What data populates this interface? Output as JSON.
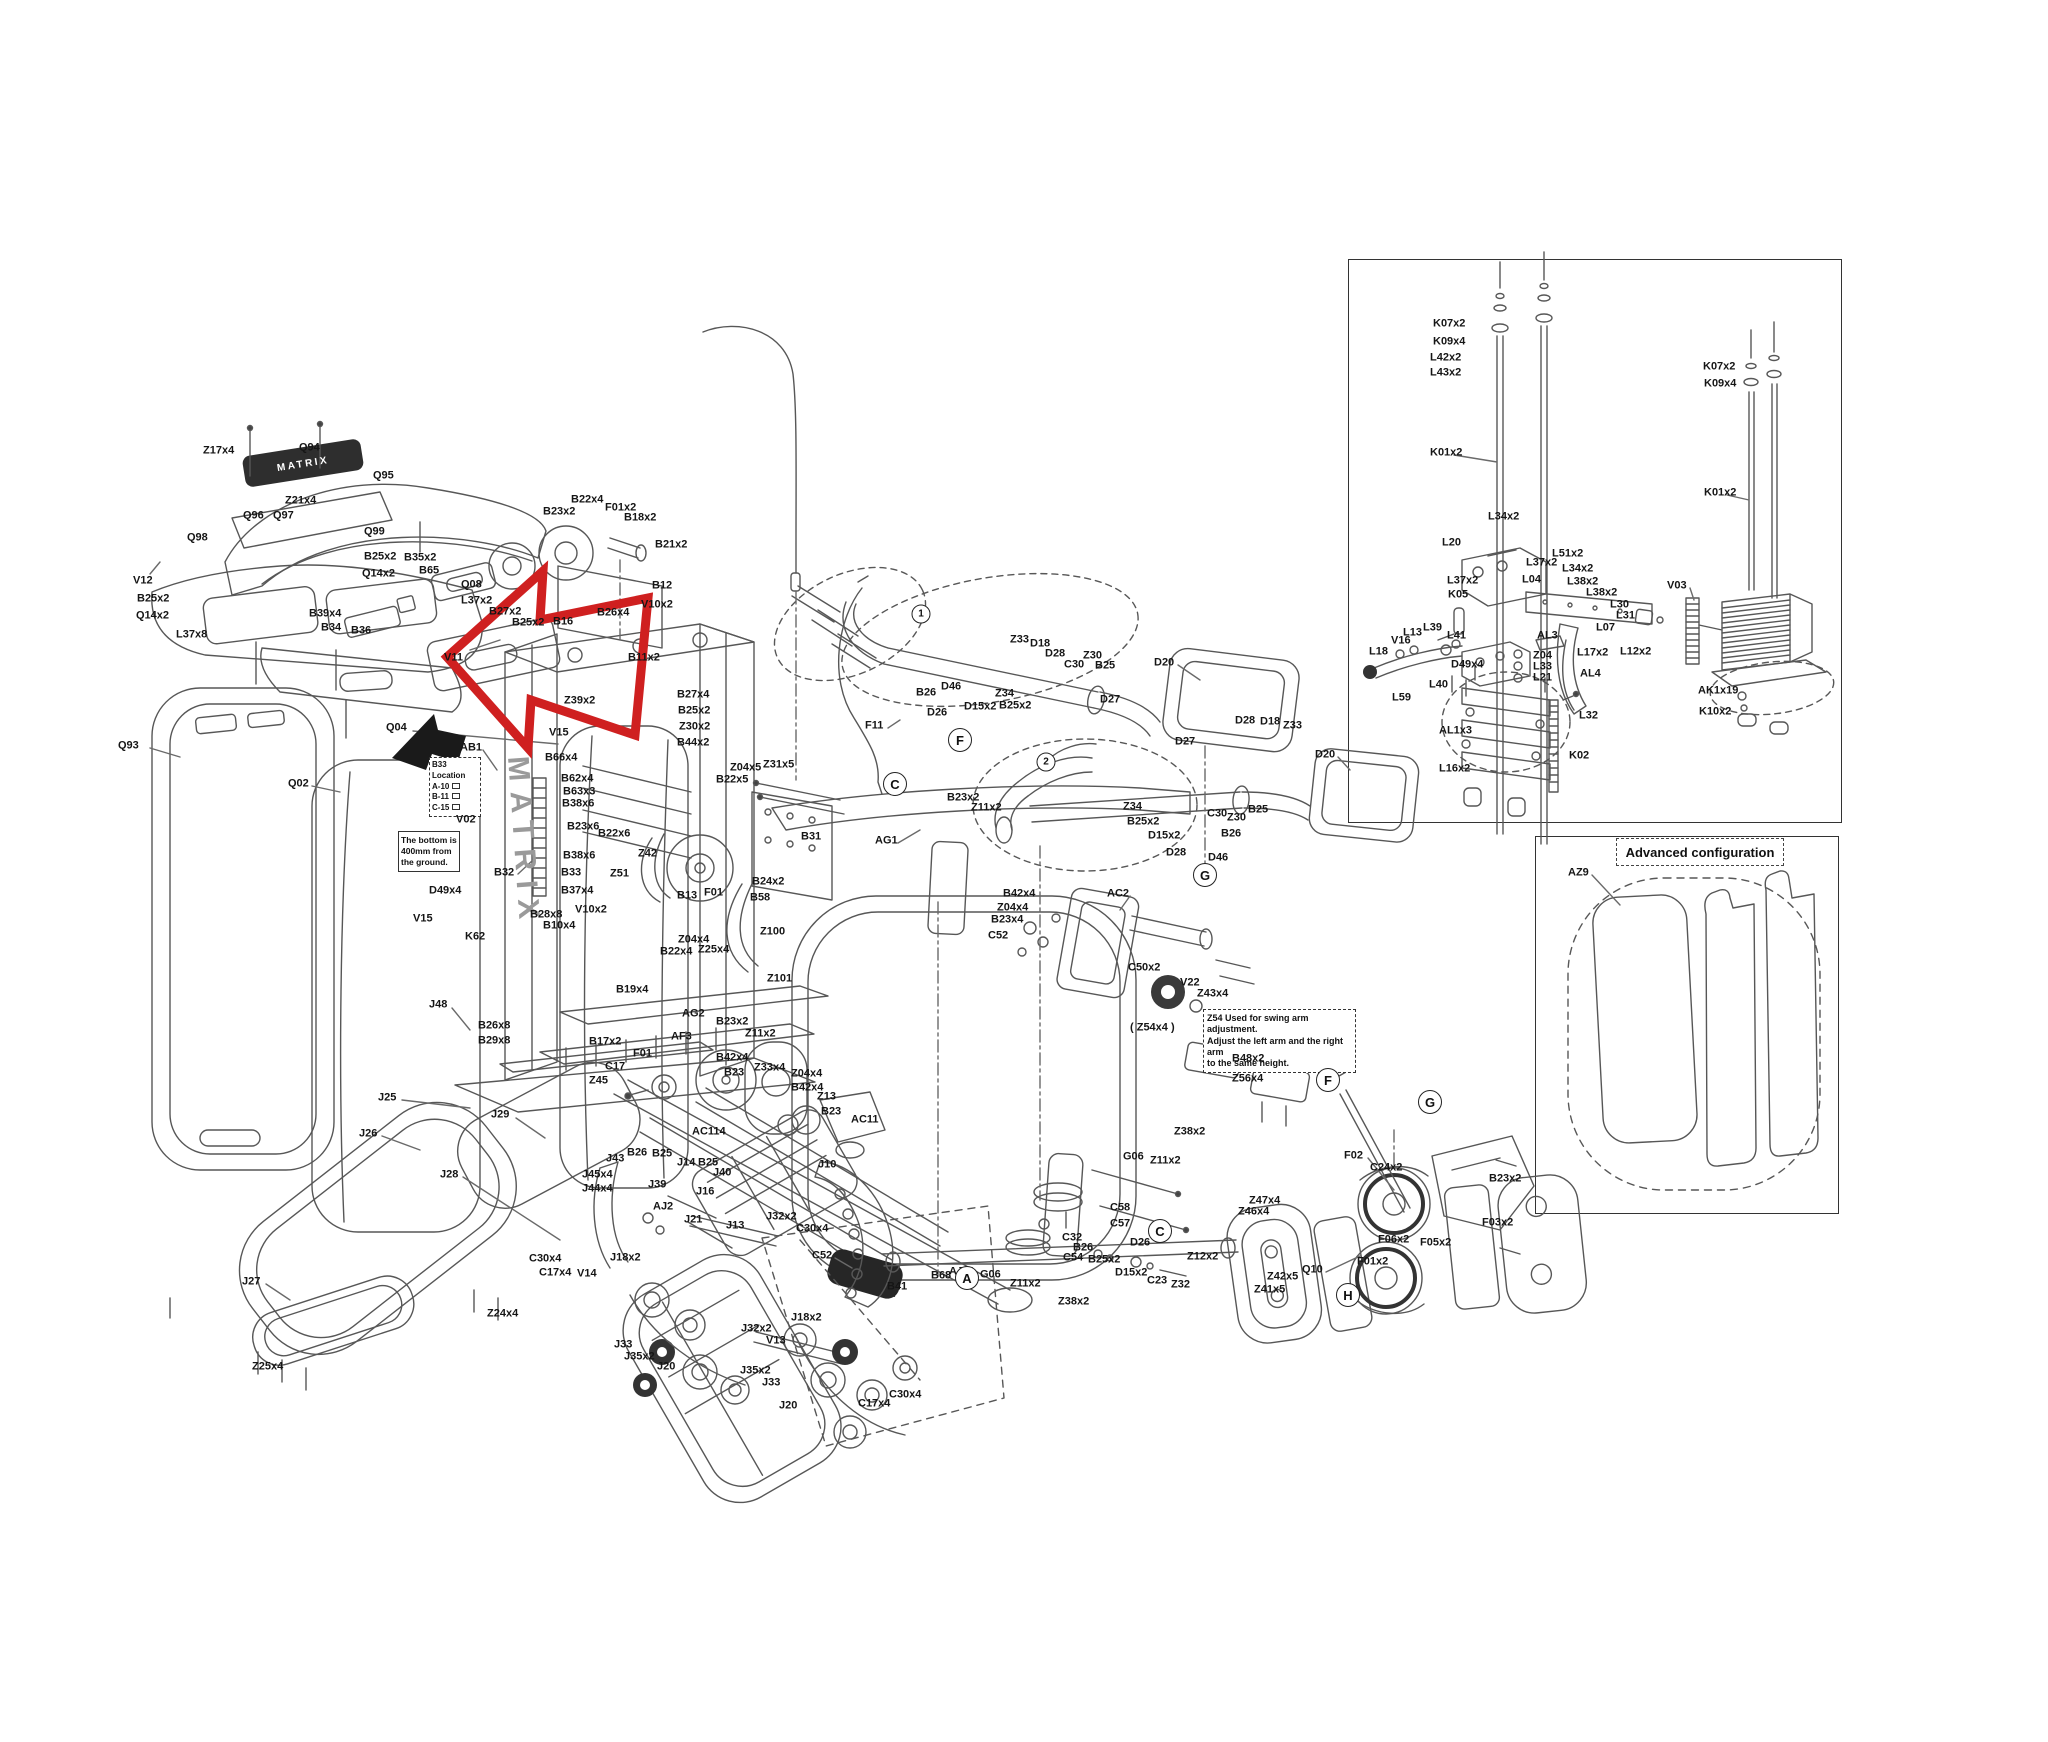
{
  "brand": {
    "logo": "MATRIX",
    "frame_text": "MATRIX"
  },
  "advanced": {
    "title": "Advanced configuration"
  },
  "notes": {
    "b33": {
      "l1": "B33",
      "l2": "Location",
      "l3": "A-10",
      "l4": "B-11",
      "l5": "C-15"
    },
    "ground": {
      "l1": "The bottom is",
      "l2": "400mm from",
      "l3": "the ground."
    },
    "z54": {
      "l1": "Z54 Used for swing arm adjustment.",
      "l2": "Adjust the left arm and the right arm",
      "l3": "to the same height."
    }
  },
  "circles": [
    {
      "t": "1",
      "x": 921,
      "y": 614,
      "sm": true
    },
    {
      "t": "2",
      "x": 1046,
      "y": 762,
      "sm": true
    },
    {
      "t": "C",
      "x": 895,
      "y": 784
    },
    {
      "t": "F",
      "x": 960,
      "y": 740
    },
    {
      "t": "G",
      "x": 1205,
      "y": 875
    },
    {
      "t": "A",
      "x": 967,
      "y": 1278
    },
    {
      "t": "C",
      "x": 1160,
      "y": 1231
    },
    {
      "t": "F",
      "x": 1328,
      "y": 1080
    },
    {
      "t": "G",
      "x": 1430,
      "y": 1102
    },
    {
      "t": "H",
      "x": 1348,
      "y": 1295
    }
  ],
  "labels": [
    {
      "t": "Z17x4",
      "x": 203,
      "y": 451
    },
    {
      "t": "Q94",
      "x": 299,
      "y": 448
    },
    {
      "t": "Q95",
      "x": 373,
      "y": 476
    },
    {
      "t": "Z21x4",
      "x": 285,
      "y": 501
    },
    {
      "t": "Q96",
      "x": 243,
      "y": 516
    },
    {
      "t": "Q97",
      "x": 273,
      "y": 516
    },
    {
      "t": "Q98",
      "x": 187,
      "y": 538
    },
    {
      "t": "Q99",
      "x": 364,
      "y": 532
    },
    {
      "t": "B25x2",
      "x": 364,
      "y": 557
    },
    {
      "t": "Q14x2",
      "x": 362,
      "y": 574
    },
    {
      "t": "B35x2",
      "x": 404,
      "y": 558
    },
    {
      "t": "B65",
      "x": 419,
      "y": 571
    },
    {
      "t": "V12",
      "x": 133,
      "y": 581
    },
    {
      "t": "B25x2",
      "x": 137,
      "y": 599
    },
    {
      "t": "Q14x2",
      "x": 136,
      "y": 616
    },
    {
      "t": "L37x8",
      "x": 176,
      "y": 635
    },
    {
      "t": "Q08",
      "x": 461,
      "y": 585
    },
    {
      "t": "L37x2",
      "x": 461,
      "y": 601
    },
    {
      "t": "B39x4",
      "x": 309,
      "y": 614
    },
    {
      "t": "B34",
      "x": 321,
      "y": 628
    },
    {
      "t": "B36",
      "x": 351,
      "y": 631
    },
    {
      "t": "V11",
      "x": 444,
      "y": 658
    },
    {
      "t": "Q93",
      "x": 118,
      "y": 746
    },
    {
      "t": "Q02",
      "x": 288,
      "y": 784
    },
    {
      "t": "Q04",
      "x": 386,
      "y": 728
    },
    {
      "t": "AB1",
      "x": 460,
      "y": 748
    },
    {
      "t": "V02",
      "x": 456,
      "y": 820
    },
    {
      "t": "D49x4",
      "x": 429,
      "y": 891
    },
    {
      "t": "V15",
      "x": 413,
      "y": 919
    },
    {
      "t": "K62",
      "x": 465,
      "y": 937
    },
    {
      "t": "J48",
      "x": 429,
      "y": 1005
    },
    {
      "t": "B23x2",
      "x": 543,
      "y": 512
    },
    {
      "t": "B22x4",
      "x": 571,
      "y": 500
    },
    {
      "t": "F01x2",
      "x": 605,
      "y": 508
    },
    {
      "t": "B18x2",
      "x": 624,
      "y": 518
    },
    {
      "t": "B21x2",
      "x": 655,
      "y": 545
    },
    {
      "t": "B12",
      "x": 652,
      "y": 586
    },
    {
      "t": "V10x2",
      "x": 641,
      "y": 605
    },
    {
      "t": "B26x4",
      "x": 597,
      "y": 613
    },
    {
      "t": "B16",
      "x": 553,
      "y": 622
    },
    {
      "t": "B27x2",
      "x": 489,
      "y": 612
    },
    {
      "t": "B25x2",
      "x": 512,
      "y": 623
    },
    {
      "t": "B11x2",
      "x": 628,
      "y": 658
    },
    {
      "t": "B27x4",
      "x": 677,
      "y": 695
    },
    {
      "t": "B25x2",
      "x": 678,
      "y": 711
    },
    {
      "t": "Z30x2",
      "x": 679,
      "y": 727
    },
    {
      "t": "B44x2",
      "x": 677,
      "y": 743
    },
    {
      "t": "Z39x2",
      "x": 564,
      "y": 701
    },
    {
      "t": "V15",
      "x": 549,
      "y": 733
    },
    {
      "t": "B66x4",
      "x": 545,
      "y": 758
    },
    {
      "t": "B62x4",
      "x": 561,
      "y": 779
    },
    {
      "t": "B63x3",
      "x": 563,
      "y": 792
    },
    {
      "t": "B38x6",
      "x": 562,
      "y": 804
    },
    {
      "t": "B23x6",
      "x": 567,
      "y": 827
    },
    {
      "t": "B22x6",
      "x": 598,
      "y": 834
    },
    {
      "t": "B38x6",
      "x": 563,
      "y": 856
    },
    {
      "t": "B33",
      "x": 561,
      "y": 873
    },
    {
      "t": "B32",
      "x": 494,
      "y": 873
    },
    {
      "t": "B37x4",
      "x": 561,
      "y": 891
    },
    {
      "t": "V10x2",
      "x": 575,
      "y": 910
    },
    {
      "t": "B28x8",
      "x": 530,
      "y": 915
    },
    {
      "t": "B10x4",
      "x": 543,
      "y": 926
    },
    {
      "t": "Z42",
      "x": 638,
      "y": 854
    },
    {
      "t": "Z51",
      "x": 610,
      "y": 874
    },
    {
      "t": "B13",
      "x": 677,
      "y": 896
    },
    {
      "t": "F01",
      "x": 704,
      "y": 893
    },
    {
      "t": "B24x2",
      "x": 752,
      "y": 882
    },
    {
      "t": "B58",
      "x": 750,
      "y": 898
    },
    {
      "t": "Z100",
      "x": 760,
      "y": 932
    },
    {
      "t": "Z04x4",
      "x": 678,
      "y": 940
    },
    {
      "t": "B22x4",
      "x": 660,
      "y": 952
    },
    {
      "t": "Z25x4",
      "x": 698,
      "y": 950
    },
    {
      "t": "Z101",
      "x": 767,
      "y": 979
    },
    {
      "t": "B19x4",
      "x": 616,
      "y": 990
    },
    {
      "t": "AG2",
      "x": 682,
      "y": 1014
    },
    {
      "t": "B23x2",
      "x": 716,
      "y": 1022
    },
    {
      "t": "Z11x2",
      "x": 745,
      "y": 1034
    },
    {
      "t": "B26x8",
      "x": 478,
      "y": 1026
    },
    {
      "t": "B29x8",
      "x": 478,
      "y": 1041
    },
    {
      "t": "B17x2",
      "x": 589,
      "y": 1042
    },
    {
      "t": "Z04x5",
      "x": 730,
      "y": 768
    },
    {
      "t": "Z31x5",
      "x": 763,
      "y": 765
    },
    {
      "t": "B22x5",
      "x": 716,
      "y": 780
    },
    {
      "t": "B31",
      "x": 801,
      "y": 837
    },
    {
      "t": "AG1",
      "x": 875,
      "y": 841
    },
    {
      "t": "AF3",
      "x": 671,
      "y": 1037
    },
    {
      "t": "F01",
      "x": 633,
      "y": 1054
    },
    {
      "t": "C17",
      "x": 605,
      "y": 1067
    },
    {
      "t": "Z45",
      "x": 589,
      "y": 1081
    },
    {
      "t": "B42x4",
      "x": 716,
      "y": 1058
    },
    {
      "t": "B23",
      "x": 724,
      "y": 1073
    },
    {
      "t": "Z33x4",
      "x": 754,
      "y": 1068
    },
    {
      "t": "Z04x4",
      "x": 791,
      "y": 1074
    },
    {
      "t": "B42x4",
      "x": 791,
      "y": 1088
    },
    {
      "t": "Z13",
      "x": 817,
      "y": 1097
    },
    {
      "t": "B23",
      "x": 821,
      "y": 1112
    },
    {
      "t": "AC11",
      "x": 851,
      "y": 1120
    },
    {
      "t": "AC114",
      "x": 692,
      "y": 1132
    },
    {
      "t": "J10",
      "x": 818,
      "y": 1165
    },
    {
      "t": "J32x2",
      "x": 766,
      "y": 1217
    },
    {
      "t": "C30x4",
      "x": 796,
      "y": 1229
    },
    {
      "t": "C52",
      "x": 812,
      "y": 1256
    },
    {
      "t": "B41",
      "x": 887,
      "y": 1287
    },
    {
      "t": "B68",
      "x": 931,
      "y": 1276
    },
    {
      "t": "G06",
      "x": 980,
      "y": 1275
    },
    {
      "t": "Z11x2",
      "x": 1010,
      "y": 1284
    },
    {
      "t": "Z38x2",
      "x": 1058,
      "y": 1302
    },
    {
      "t": "C58",
      "x": 1110,
      "y": 1208
    },
    {
      "t": "C57",
      "x": 1110,
      "y": 1224
    },
    {
      "t": "C32",
      "x": 1062,
      "y": 1238
    },
    {
      "t": "B26",
      "x": 1073,
      "y": 1248
    },
    {
      "t": "C54",
      "x": 1063,
      "y": 1258
    },
    {
      "t": "B25x2",
      "x": 1088,
      "y": 1260
    },
    {
      "t": "D26",
      "x": 1130,
      "y": 1243
    },
    {
      "t": "D15x2",
      "x": 1115,
      "y": 1273
    },
    {
      "t": "C23",
      "x": 1147,
      "y": 1281
    },
    {
      "t": "Z32",
      "x": 1171,
      "y": 1285
    },
    {
      "t": "AJ11",
      "x": 949,
      "y": 1272
    },
    {
      "t": "Z33",
      "x": 1010,
      "y": 640
    },
    {
      "t": "D18",
      "x": 1030,
      "y": 644
    },
    {
      "t": "D28",
      "x": 1045,
      "y": 654
    },
    {
      "t": "C30",
      "x": 1064,
      "y": 665
    },
    {
      "t": "Z30",
      "x": 1083,
      "y": 656
    },
    {
      "t": "B25",
      "x": 1095,
      "y": 666
    },
    {
      "t": "D20",
      "x": 1154,
      "y": 663
    },
    {
      "t": "D27",
      "x": 1100,
      "y": 700
    },
    {
      "t": "B26",
      "x": 916,
      "y": 693
    },
    {
      "t": "D46",
      "x": 941,
      "y": 687
    },
    {
      "t": "Z34",
      "x": 995,
      "y": 694
    },
    {
      "t": "D15x2",
      "x": 964,
      "y": 707
    },
    {
      "t": "B25x2",
      "x": 999,
      "y": 706
    },
    {
      "t": "D26",
      "x": 927,
      "y": 713
    },
    {
      "t": "F11",
      "x": 865,
      "y": 726
    },
    {
      "t": "B23x2",
      "x": 947,
      "y": 798
    },
    {
      "t": "Z11x2",
      "x": 971,
      "y": 808
    },
    {
      "t": "D27",
      "x": 1175,
      "y": 742
    },
    {
      "t": "D28",
      "x": 1235,
      "y": 721
    },
    {
      "t": "D18",
      "x": 1260,
      "y": 722
    },
    {
      "t": "Z33",
      "x": 1283,
      "y": 726
    },
    {
      "t": "D20",
      "x": 1315,
      "y": 755
    },
    {
      "t": "Z34",
      "x": 1123,
      "y": 807
    },
    {
      "t": "B25x2",
      "x": 1127,
      "y": 822
    },
    {
      "t": "C30",
      "x": 1207,
      "y": 814
    },
    {
      "t": "Z30",
      "x": 1227,
      "y": 818
    },
    {
      "t": "B25",
      "x": 1248,
      "y": 810
    },
    {
      "t": "B26",
      "x": 1221,
      "y": 834
    },
    {
      "t": "D15x2",
      "x": 1148,
      "y": 836
    },
    {
      "t": "D28",
      "x": 1166,
      "y": 853
    },
    {
      "t": "D46",
      "x": 1208,
      "y": 858
    },
    {
      "t": "B42x4",
      "x": 1003,
      "y": 894
    },
    {
      "t": "Z04x4",
      "x": 997,
      "y": 908
    },
    {
      "t": "B23x4",
      "x": 991,
      "y": 920
    },
    {
      "t": "C52",
      "x": 988,
      "y": 936
    },
    {
      "t": "AC2",
      "x": 1107,
      "y": 894
    },
    {
      "t": "C50x2",
      "x": 1128,
      "y": 968
    },
    {
      "t": "V22",
      "x": 1180,
      "y": 983
    },
    {
      "t": "Z43x4",
      "x": 1197,
      "y": 994
    },
    {
      "t": "( Z54x4 )",
      "x": 1130,
      "y": 1028
    },
    {
      "t": "B48x2",
      "x": 1232,
      "y": 1059
    },
    {
      "t": "Z56x4",
      "x": 1232,
      "y": 1079
    },
    {
      "t": "Z38x2",
      "x": 1174,
      "y": 1132
    },
    {
      "t": "G06",
      "x": 1123,
      "y": 1157
    },
    {
      "t": "Z11x2",
      "x": 1150,
      "y": 1161
    },
    {
      "t": "F02",
      "x": 1344,
      "y": 1156
    },
    {
      "t": "C24x2",
      "x": 1370,
      "y": 1168
    },
    {
      "t": "Z47x4",
      "x": 1249,
      "y": 1201
    },
    {
      "t": "Z46x4",
      "x": 1238,
      "y": 1212
    },
    {
      "t": "Z12x2",
      "x": 1187,
      "y": 1257
    },
    {
      "t": "Z42x5",
      "x": 1267,
      "y": 1277
    },
    {
      "t": "Z41x5",
      "x": 1254,
      "y": 1290
    },
    {
      "t": "Q10",
      "x": 1302,
      "y": 1270
    },
    {
      "t": "F01x2",
      "x": 1357,
      "y": 1262
    },
    {
      "t": "F06x2",
      "x": 1378,
      "y": 1240
    },
    {
      "t": "F05x2",
      "x": 1420,
      "y": 1243
    },
    {
      "t": "F03x2",
      "x": 1482,
      "y": 1223
    },
    {
      "t": "B23x2",
      "x": 1489,
      "y": 1179
    },
    {
      "t": "J25",
      "x": 378,
      "y": 1098
    },
    {
      "t": "J26",
      "x": 359,
      "y": 1134
    },
    {
      "t": "J29",
      "x": 491,
      "y": 1115
    },
    {
      "t": "J28",
      "x": 440,
      "y": 1175
    },
    {
      "t": "J27",
      "x": 242,
      "y": 1282
    },
    {
      "t": "Z25x4",
      "x": 252,
      "y": 1367
    },
    {
      "t": "Z24x4",
      "x": 487,
      "y": 1314
    },
    {
      "t": "J43",
      "x": 606,
      "y": 1159
    },
    {
      "t": "B26",
      "x": 627,
      "y": 1153
    },
    {
      "t": "B25",
      "x": 652,
      "y": 1154
    },
    {
      "t": "J45x4",
      "x": 582,
      "y": 1175
    },
    {
      "t": "J44x4",
      "x": 582,
      "y": 1189
    },
    {
      "t": "J14",
      "x": 677,
      "y": 1163
    },
    {
      "t": "B25",
      "x": 698,
      "y": 1163
    },
    {
      "t": "J40",
      "x": 713,
      "y": 1173
    },
    {
      "t": "J39",
      "x": 648,
      "y": 1185
    },
    {
      "t": "J16",
      "x": 696,
      "y": 1192
    },
    {
      "t": "AJ2",
      "x": 653,
      "y": 1207
    },
    {
      "t": "J21",
      "x": 684,
      "y": 1220
    },
    {
      "t": "J13",
      "x": 726,
      "y": 1226
    },
    {
      "t": "C30x4",
      "x": 529,
      "y": 1259
    },
    {
      "t": "C17x4",
      "x": 539,
      "y": 1273
    },
    {
      "t": "V14",
      "x": 577,
      "y": 1274
    },
    {
      "t": "J18x2",
      "x": 610,
      "y": 1258
    },
    {
      "t": "J33",
      "x": 614,
      "y": 1345
    },
    {
      "t": "J35x2",
      "x": 624,
      "y": 1357
    },
    {
      "t": "J20",
      "x": 657,
      "y": 1367
    },
    {
      "t": "J32x2",
      "x": 741,
      "y": 1329
    },
    {
      "t": "V13",
      "x": 766,
      "y": 1341
    },
    {
      "t": "J35x2",
      "x": 740,
      "y": 1371
    },
    {
      "t": "J33",
      "x": 762,
      "y": 1383
    },
    {
      "t": "J20",
      "x": 779,
      "y": 1406
    },
    {
      "t": "J18x2",
      "x": 791,
      "y": 1318
    },
    {
      "t": "C30x4",
      "x": 889,
      "y": 1395
    },
    {
      "t": "C17x4",
      "x": 858,
      "y": 1404
    },
    {
      "t": "K07x2",
      "x": 1433,
      "y": 324
    },
    {
      "t": "K09x4",
      "x": 1433,
      "y": 342
    },
    {
      "t": "L42x2",
      "x": 1430,
      "y": 358
    },
    {
      "t": "L43x2",
      "x": 1430,
      "y": 373
    },
    {
      "t": "K01x2",
      "x": 1430,
      "y": 453
    },
    {
      "t": "L34x2",
      "x": 1488,
      "y": 517
    },
    {
      "t": "L20",
      "x": 1442,
      "y": 543
    },
    {
      "t": "L37x2",
      "x": 1526,
      "y": 563
    },
    {
      "t": "L51x2",
      "x": 1552,
      "y": 554
    },
    {
      "t": "L34x2",
      "x": 1562,
      "y": 569
    },
    {
      "t": "L04",
      "x": 1522,
      "y": 580
    },
    {
      "t": "L38x2",
      "x": 1567,
      "y": 582
    },
    {
      "t": "L38x2",
      "x": 1586,
      "y": 593
    },
    {
      "t": "L37x2",
      "x": 1447,
      "y": 581
    },
    {
      "t": "K05",
      "x": 1448,
      "y": 595
    },
    {
      "t": "L30",
      "x": 1610,
      "y": 605
    },
    {
      "t": "L31",
      "x": 1616,
      "y": 616
    },
    {
      "t": "L07",
      "x": 1596,
      "y": 628
    },
    {
      "t": "L13",
      "x": 1403,
      "y": 633
    },
    {
      "t": "L39",
      "x": 1423,
      "y": 628
    },
    {
      "t": "V16",
      "x": 1391,
      "y": 641
    },
    {
      "t": "L18",
      "x": 1369,
      "y": 652
    },
    {
      "t": "L41",
      "x": 1447,
      "y": 636
    },
    {
      "t": "AL3",
      "x": 1537,
      "y": 636
    },
    {
      "t": "Z04",
      "x": 1533,
      "y": 656
    },
    {
      "t": "L33",
      "x": 1533,
      "y": 667
    },
    {
      "t": "L21",
      "x": 1533,
      "y": 678
    },
    {
      "t": "L17x2",
      "x": 1577,
      "y": 653
    },
    {
      "t": "L12x2",
      "x": 1620,
      "y": 652
    },
    {
      "t": "AL4",
      "x": 1580,
      "y": 674
    },
    {
      "t": "D49x4",
      "x": 1451,
      "y": 665
    },
    {
      "t": "L40",
      "x": 1429,
      "y": 685
    },
    {
      "t": "L59",
      "x": 1392,
      "y": 698
    },
    {
      "t": "AL1x3",
      "x": 1439,
      "y": 731
    },
    {
      "t": "L16x2",
      "x": 1439,
      "y": 769
    },
    {
      "t": "L32",
      "x": 1579,
      "y": 716
    },
    {
      "t": "K02",
      "x": 1569,
      "y": 756
    },
    {
      "t": "V03",
      "x": 1667,
      "y": 586
    },
    {
      "t": "AK1x19",
      "x": 1698,
      "y": 691
    },
    {
      "t": "K10x2",
      "x": 1699,
      "y": 712
    },
    {
      "t": "K07x2",
      "x": 1703,
      "y": 367
    },
    {
      "t": "K09x4",
      "x": 1704,
      "y": 384
    },
    {
      "t": "K01x2",
      "x": 1704,
      "y": 493
    },
    {
      "t": "AZ9",
      "x": 1568,
      "y": 873
    }
  ]
}
